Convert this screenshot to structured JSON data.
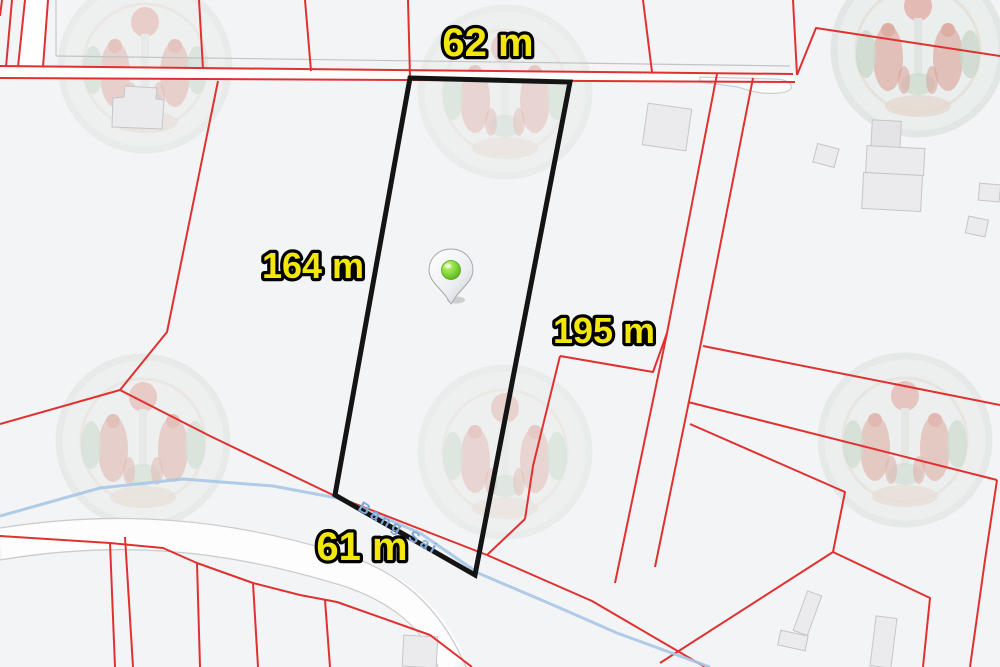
{
  "map": {
    "background_color": "#f3f4f6",
    "parcel_line_color": "#e03131",
    "road_casing_color": "#cccccc",
    "building_fill_color": "#ebebed",
    "plot": {
      "outline_color": "#141414",
      "measurements": {
        "top": "62 m",
        "left": "164 m",
        "right": "195 m",
        "bottom": "61 m"
      },
      "label_color": "#f2e60d",
      "label_outline_color": "#000000"
    },
    "stream": {
      "name": "Bang Sai",
      "color": "#a9c7e6",
      "label_color": "#7fa8d8"
    },
    "marker": {
      "icon": "location-pin-icon",
      "dot_color": "#5cb81a"
    },
    "watermark": {
      "icon": "official-seal-watermark-icon",
      "count": 6
    }
  }
}
